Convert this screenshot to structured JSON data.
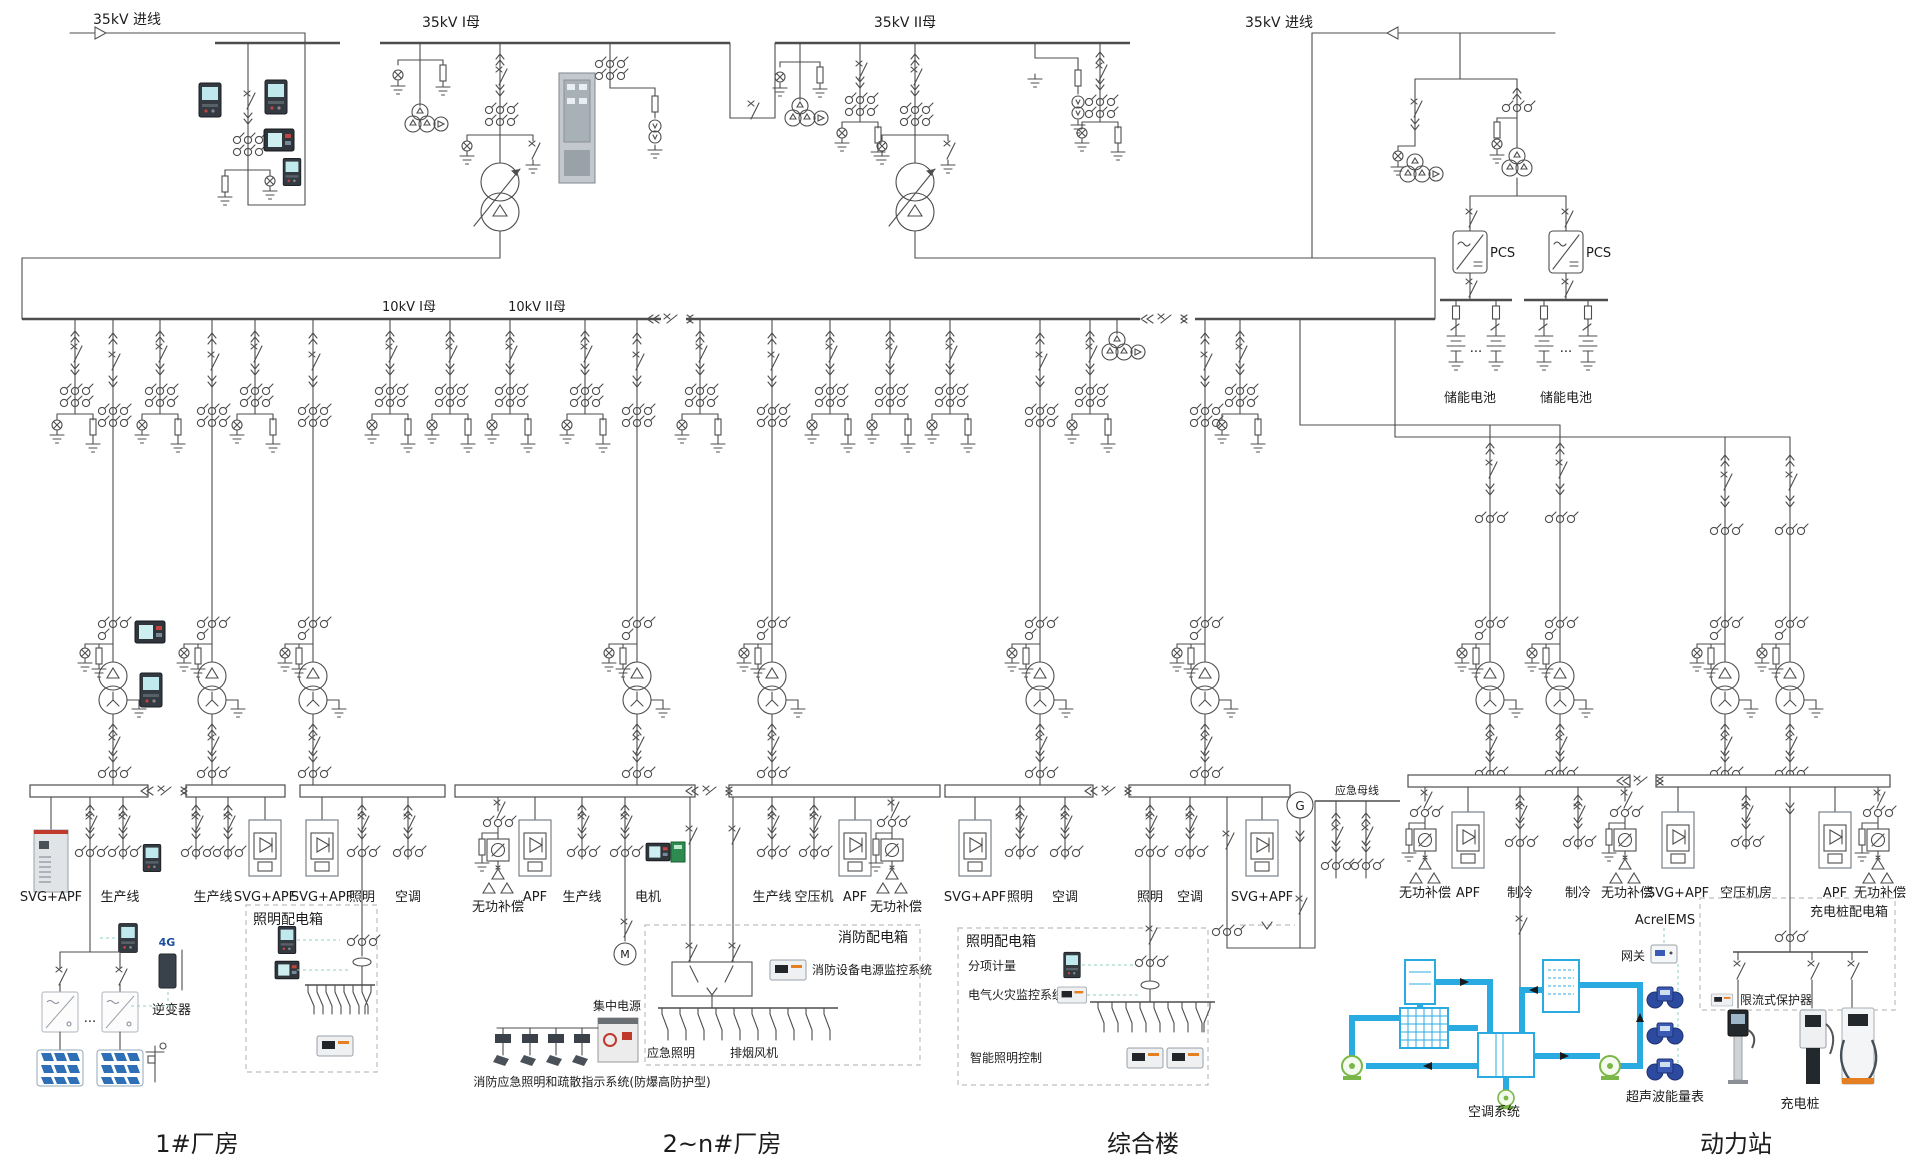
{
  "diagram": {
    "incoming_left": "35kV 进线",
    "incoming_right": "35kV 进线",
    "bus_35kv_1": "35kV I母",
    "bus_35kv_2": "35kV II母",
    "bus_10kv_1": "10kV I母",
    "bus_10kv_2": "10kV II母",
    "pcs": "PCS",
    "battery": "储能电池",
    "dots": "...",
    "emergency_bus": "应急母线",
    "generator": "G",
    "motor": "M"
  },
  "plant1": {
    "title": "1#厂房",
    "feeders": [
      "SVG+APF",
      "生产线",
      "生产线",
      "SVG+APF",
      "SVG+APF",
      "照明",
      "空调"
    ],
    "inverter": "逆变器",
    "signal": "4G",
    "lighting_box": "照明配电箱"
  },
  "plant2": {
    "title": "2~n#厂房",
    "feeders": [
      "无功补偿",
      "APF",
      "生产线",
      "电机",
      "生产线",
      "空压机",
      "APF",
      "无功补偿"
    ],
    "fire_box": "消防配电箱",
    "fire_monitor": "消防设备电源监控系统",
    "central_power": "集中电源",
    "emergency_lighting": "应急照明",
    "smoke_fan": "排烟风机",
    "system_note": "消防应急照明和疏散指示系统(防爆高防护型)"
  },
  "complex": {
    "title": "综合楼",
    "feeders": [
      "SVG+APF",
      "照明",
      "空调",
      "照明",
      "空调",
      "SVG+APF"
    ],
    "lighting_box": "照明配电箱",
    "sub_metering": "分项计量",
    "fire_monitor": "电气火灾监控系统",
    "smart_lighting": "智能照明控制"
  },
  "station": {
    "title": "动力站",
    "feeders_a": [
      "无功补偿",
      "APF",
      "制冷",
      "制冷",
      "无功补偿"
    ],
    "feeders_b": [
      "SVG+APF",
      "空压机房",
      "APF",
      "无功补偿"
    ],
    "charging_box": "充电桩配电箱",
    "protector": "限流式保护器",
    "charging_pile": "充电桩",
    "ems": "AcrelEMS",
    "gateway": "网关",
    "ultrasonic_meter": "超声波能量表",
    "hvac": "空调系统"
  }
}
